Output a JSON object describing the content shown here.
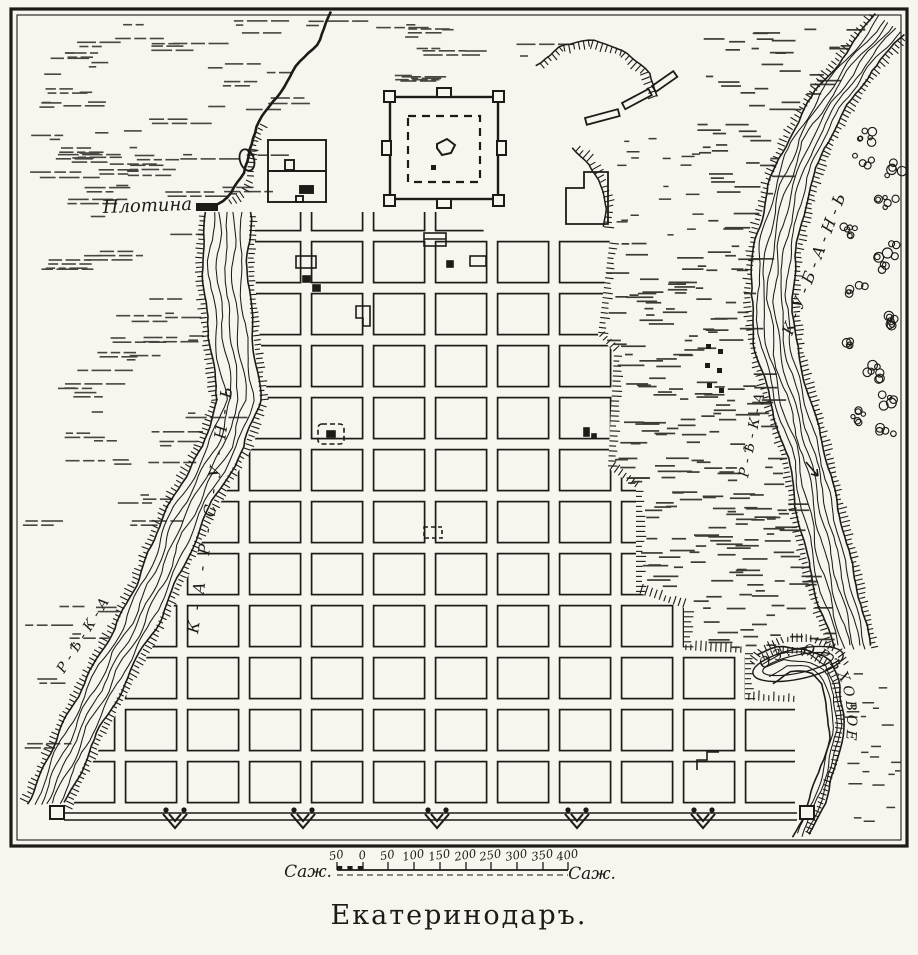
{
  "map": {
    "title": "Екатеринодаръ.",
    "labels": {
      "dam": "Плотина",
      "river_karsun": "К-А-Р-С-У-Н-Ь",
      "river_karsun_reka": "Р-Ѣ-К-А",
      "river_kuban": "К-У-Б-А-Н-Ь",
      "river_kuban_reka": "Р-Ѣ-К-А",
      "lake": "ОЗ. ОРѢХОВОЕ"
    },
    "scale": {
      "unit_left": "Саж.",
      "unit_right": "Саж.",
      "ticks": [
        "50",
        "0",
        "50",
        "100",
        "150",
        "200",
        "250",
        "300",
        "350",
        "400"
      ]
    },
    "colors": {
      "ink": "#1d1b18",
      "paper": "#f7f5ee"
    }
  }
}
